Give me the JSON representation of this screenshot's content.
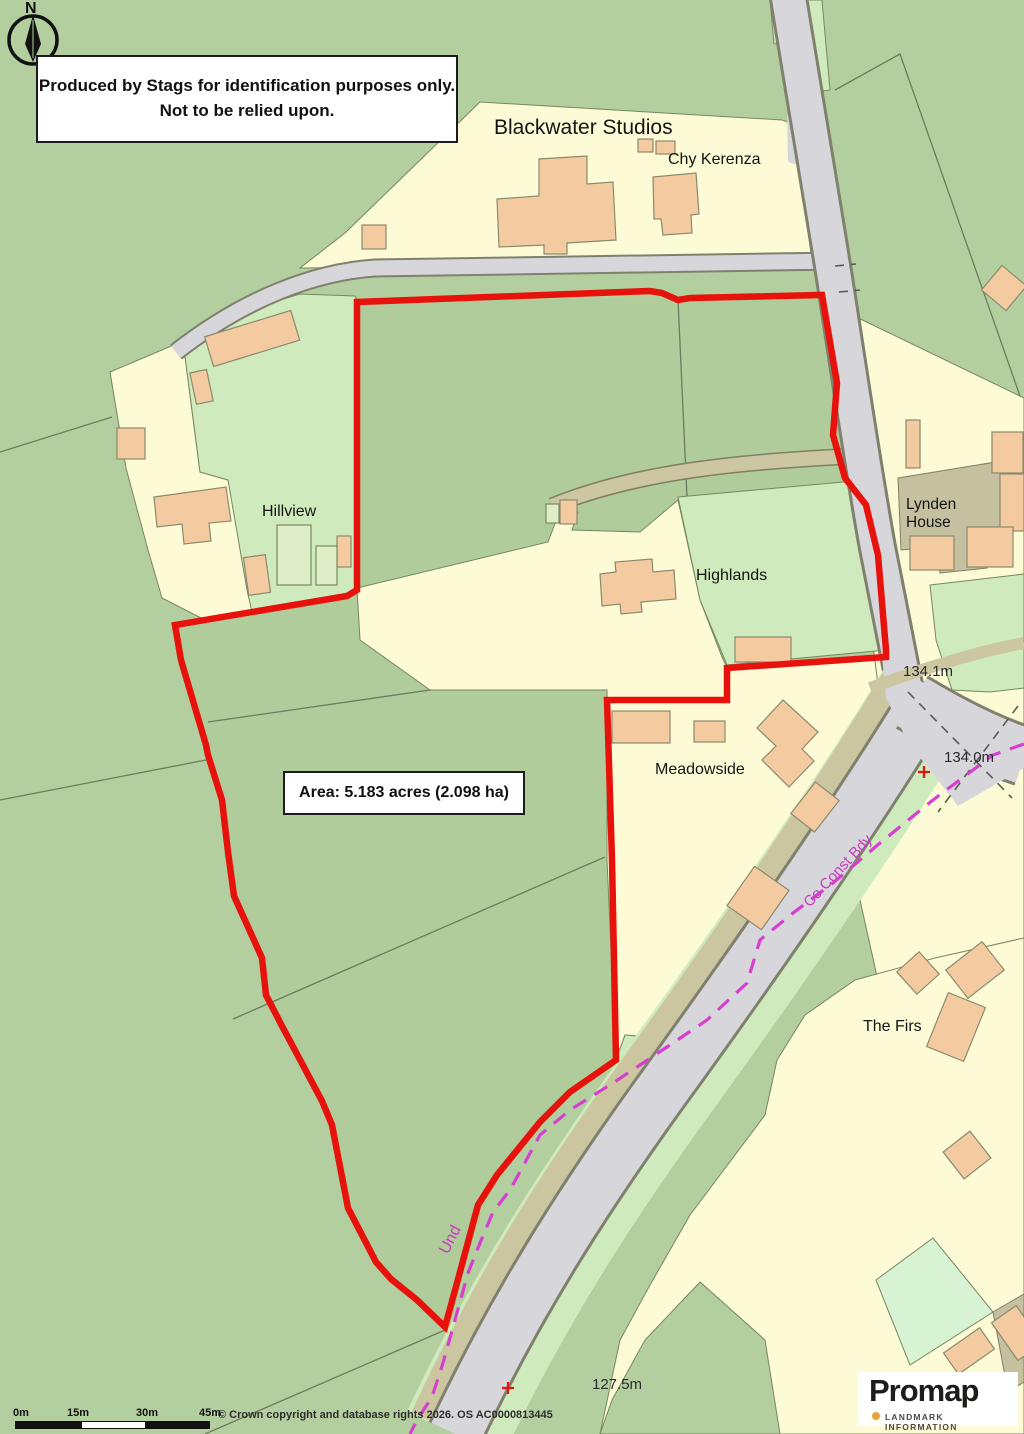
{
  "disclaimer": {
    "line1": "Produced by Stags for identification purposes only.",
    "line2": "Not to be relied upon."
  },
  "area_box": {
    "label": "Area: 5.183 acres (2.098 ha)"
  },
  "north": {
    "label": "N"
  },
  "places": {
    "blackwater": "Blackwater Studios",
    "chy_kerenza": "Chy Kerenza",
    "hillview": "Hillview",
    "highlands": "Highlands",
    "lynden_line1": "Lynden",
    "lynden_line2": "House",
    "meadowside": "Meadowside",
    "the_firs": "The Firs"
  },
  "elevations": {
    "e1": "134.1m",
    "e2": "134.0m",
    "e3": "127.5m"
  },
  "boundary_labels": {
    "co_const": "Co Const Bdy",
    "und": "Und"
  },
  "scale_bar": {
    "t0": "0m",
    "t15": "15m",
    "t30": "30m",
    "t45": "45m"
  },
  "copyright": "© Crown copyright and database rights 2026. OS AC0000813445",
  "logo": {
    "name": "Promap",
    "tagline": "LANDMARK INFORMATION"
  },
  "colors": {
    "boundary_red": "#e8120c",
    "county_boundary_magenta": "#d63fd0",
    "field_sage": "#b4cf9f",
    "parcel_cream": "#fdfad6",
    "parcel_light_green": "#cfeabc",
    "building_tan": "#f4cba1",
    "road_gray": "#d7d6db",
    "track_khaki": "#ccc7a2"
  }
}
